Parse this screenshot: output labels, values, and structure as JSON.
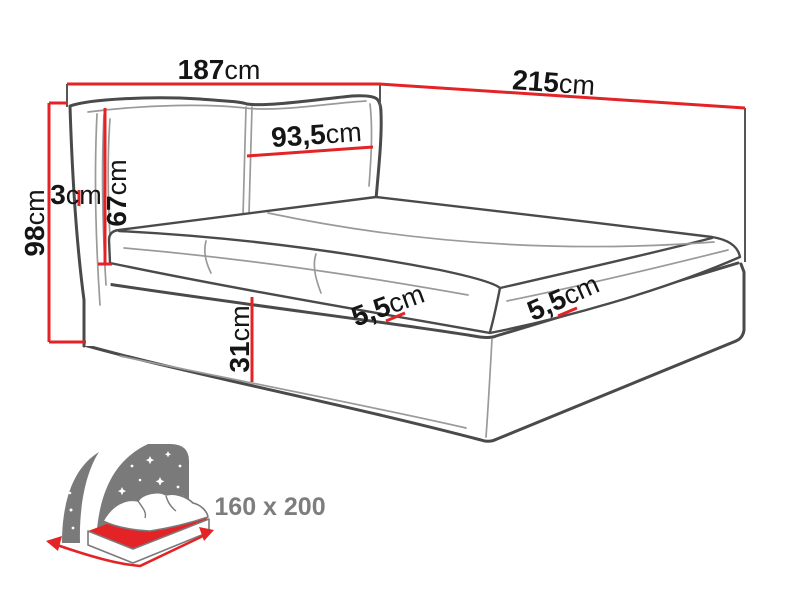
{
  "figure": {
    "type": "bed-dimension-diagram",
    "description": "Line drawing of an upholstered bed with headboard cushions, mattress and storage frame, annotated with red dimension lines"
  },
  "dimensions": {
    "width": {
      "value": "187",
      "unit": "cm"
    },
    "length": {
      "value": "215",
      "unit": "cm"
    },
    "total_height": {
      "value": "98",
      "unit": "cm"
    },
    "headboard_height": {
      "value": "67",
      "unit": "cm"
    },
    "headboard_side": {
      "value": "3",
      "unit": "cm"
    },
    "pillow_width": {
      "value": "93,5",
      "unit": "cm"
    },
    "base_height": {
      "value": "31",
      "unit": "cm"
    },
    "lip_front": {
      "value": "5,5",
      "unit": "cm"
    },
    "lip_side": {
      "value": "5,5",
      "unit": "cm"
    }
  },
  "badge": {
    "mattress_size": "160 x 200"
  },
  "colors": {
    "dimension_red": "#e42327",
    "outline": "#4a4a4a",
    "seam": "#9a9a9a",
    "icon_gray": "#7a7a7a",
    "badge_text": "#7d7d7d",
    "label_text": "#151515"
  }
}
